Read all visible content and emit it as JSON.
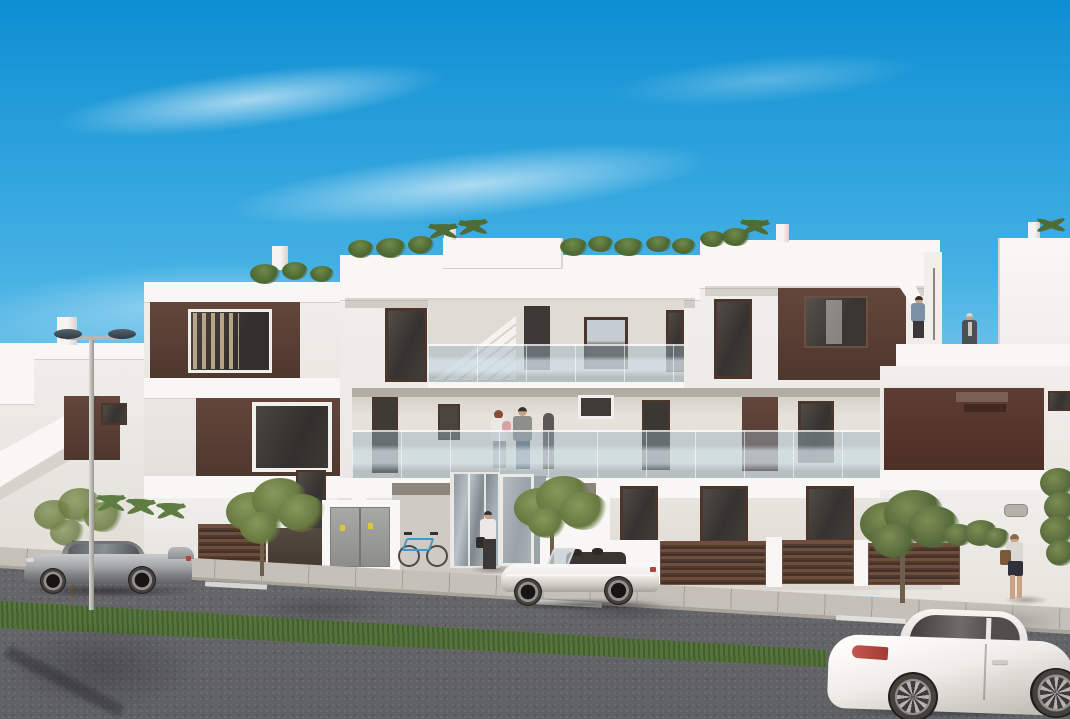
{
  "meta": {
    "description": "Architectural render of a modern white three-storey apartment building with dark brown accent panels, glass balconies, rooftop greenery and palms; street scene in front with a twin-arm street lamp, a parked silver coupe, a white convertible, a white coupe driving, a blue bicycle, trees, brown slatted fences and five people under a clear blue sky",
    "width": 1070,
    "height": 719
  },
  "palette": {
    "skyTop": "#0d8ed2",
    "skyMid": "#45b1e4",
    "skyLow": "#a9daf1",
    "horizon": "#e2f1f9",
    "whiteHi": "#f8f7f5",
    "white": "#f1efec",
    "whiteShade": "#e3e0da",
    "wallShade": "#d7d3cc",
    "panelBrown": "#63463b",
    "panelBrownD": "#4e372d",
    "frameBrown": "#4a362c",
    "glassDark": "#37332f",
    "railGlass": "#9db3c1",
    "sidewalk": "#ccc7bf",
    "curb": "#aaa49b",
    "roadFar": "#8b8b8e",
    "roadNear": "#636467",
    "grass": "#5b7d3c",
    "tree": "#6e7e4c",
    "trunk": "#6e5f4c",
    "silver": "#a7a8ab",
    "carWhite": "#f3f1ee",
    "tail": "#b2423a",
    "skin": "#c9a286",
    "hairDark": "#36302b",
    "hairRed": "#8a4a38",
    "shirtWhite": "#ebe9e5",
    "shirtBlue": "#7b90a5",
    "shirtGray": "#8e8e8c",
    "denim": "#5c6a7c",
    "pantsDark": "#3b383a",
    "babyPink": "#d9a3a3",
    "bagBrown": "#7b5839",
    "cabinetGray": "#9b9b99",
    "stickerYellow": "#d8c83a",
    "lampHead": "#3e4a56",
    "pole": "#c9c6c1"
  },
  "scene": {
    "objects": [
      "blue-sky-with-cloud-wisps",
      "apartment-building-white-brown",
      "rooftop-shrubs-and-palms",
      "roof-bulkhead-and-chimneys",
      "exterior-staircase-glass-balustrade",
      "balcony-family-with-baby",
      "roof-terrace-man-on-stairs",
      "roof-terrace-woman",
      "entrance-glazing-and-door",
      "utility-cabinet-yellow-stickers",
      "blue-bicycle",
      "entrance-man-white-shirt",
      "brown-slatted-fences",
      "street-trees",
      "street-lamp-twin-arm",
      "silver-coupe-parked",
      "white-convertible-parked",
      "white-coupe-driving",
      "sidewalk-woman-with-handbag",
      "grass-median",
      "asphalt-road-dashed-lines"
    ]
  }
}
